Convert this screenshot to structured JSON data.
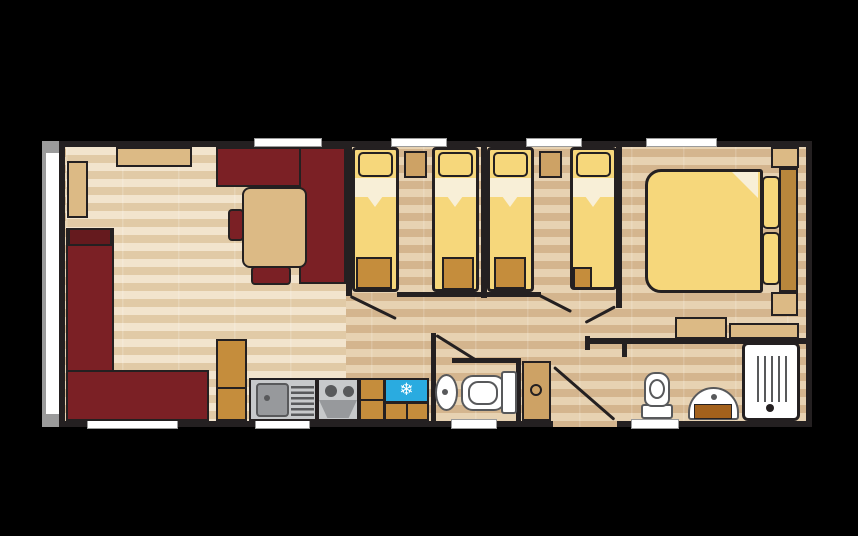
{
  "colors": {
    "background": "#000000",
    "wall": "#242021",
    "floor_light_a": "#f2e4cd",
    "floor_light_b": "#e1caa6",
    "floor_dark_a": "#e7d2b2",
    "floor_dark_b": "#d4b58e",
    "maroon": "#7b2025",
    "maroon_dark": "#651a1e",
    "tan": "#dcba85",
    "tan_orange": "#c58d3c",
    "lt_brown": "#cda265",
    "brown": "#b9873c",
    "cabinet_brown": "#a3611c",
    "bed_yellow": "#f6d77b",
    "sheet_cream": "#f8efd7",
    "fridge_blue": "#2aabe0",
    "appliance_gray": "#c7c9cb",
    "appliance_gray_dark": "#97999c",
    "detail_gray": "#58595b",
    "white": "#ffffff",
    "window_gray": "#9b9b9b"
  },
  "icons": {
    "snowflake": "❄"
  }
}
